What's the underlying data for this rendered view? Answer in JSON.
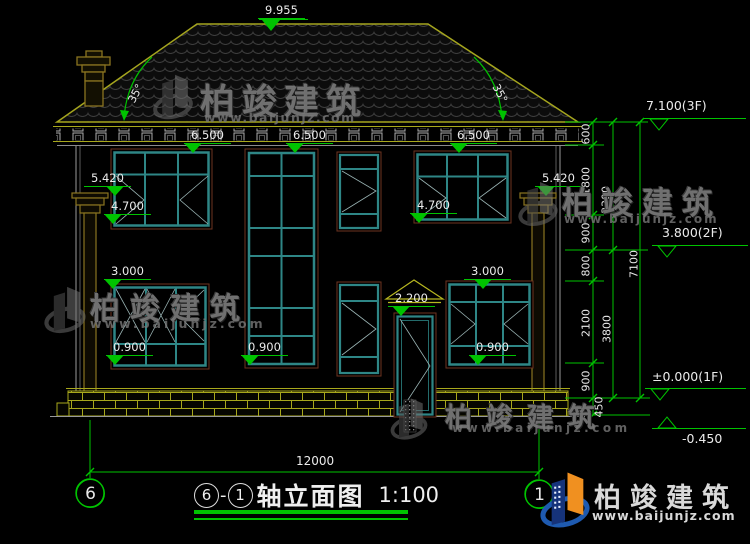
{
  "drawing_title": {
    "axis_start": "6",
    "separator": "-",
    "axis_end": "1",
    "name": "轴立面图",
    "scale": "1:100"
  },
  "labels": {
    "ridge_elevation": "9.955",
    "roof_angle": "35°",
    "win_head_2f": "6.500",
    "eave_trim": "5.420",
    "win_sill_2f": "4.700",
    "win_head_1f": "3.000",
    "win_sill_1f": "0.900",
    "door_head": "2.200"
  },
  "right_dimension_chain": {
    "segments": [
      "600",
      "1800",
      "900",
      "800",
      "2100",
      "900",
      "450"
    ],
    "groups": [
      "3300",
      "3800"
    ],
    "overall": "7100"
  },
  "floor_markers": {
    "f3": "7.100(3F)",
    "f2": "3.800(2F)",
    "f1": "±0.000(1F)",
    "ground": "-0.450"
  },
  "bottom_dimension": "12000",
  "axis_bubbles": {
    "left": "6",
    "right": "1"
  },
  "watermark": {
    "brand": "柏竣建筑",
    "website": "www.baijunjz.com"
  },
  "colors": {
    "dim_green": "#00c300",
    "cad_yellow": "#a8a81c",
    "window_teal": "#2e8686",
    "frame_maroon": "#6e3320",
    "logo_blue": "#1e5ab0",
    "logo_orange": "#f09020"
  }
}
